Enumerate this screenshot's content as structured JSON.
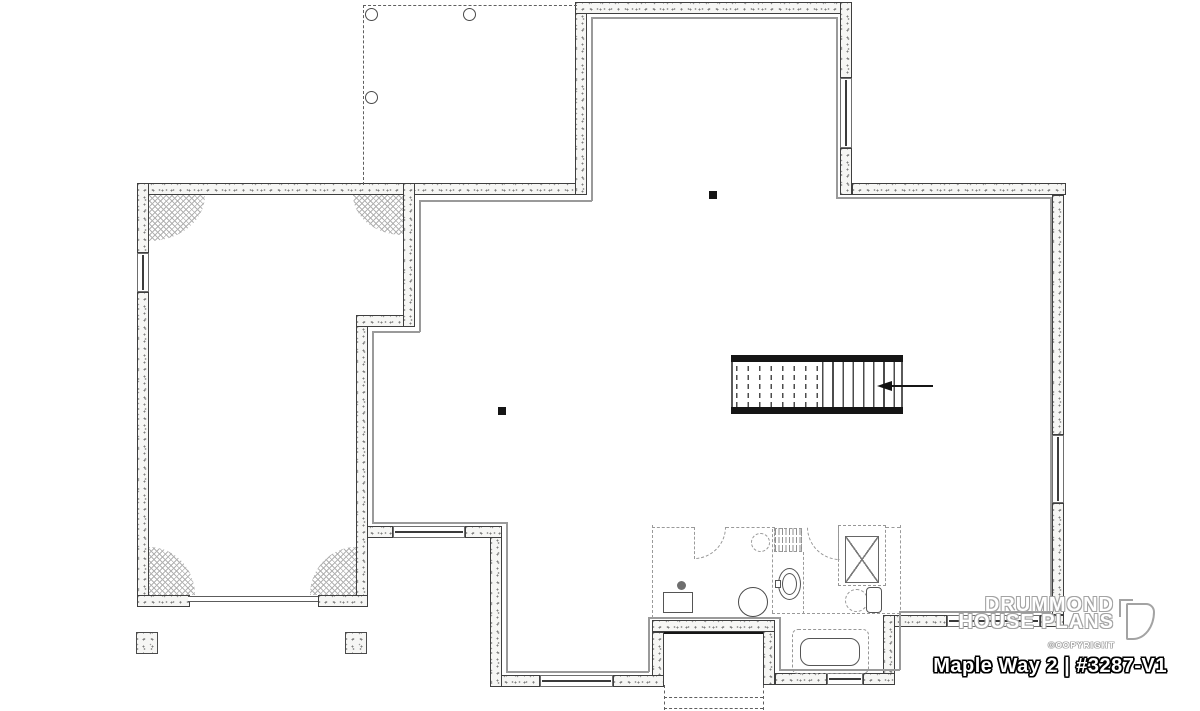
{
  "title_block": {
    "brand_line1": "DRUMMOND",
    "brand_line2": "HOUSE PLANS",
    "copyright": "©COPYRIGHT",
    "plan_title": "Maple Way 2 | #3287-V1"
  },
  "colors": {
    "wall_line": "#3f3f3f",
    "stipple": "#8a8a8a",
    "finish_line": "#9a9a9a",
    "dash_dark": "#5f5f5f",
    "dash_light": "#9a9a9a",
    "fixture_line": "#555555",
    "title_fill": "#ffffff",
    "title_outline": "#000000",
    "brand_outline": "#a3a3a3"
  },
  "plan": {
    "items": [
      {
        "t": "wall",
        "n": "garage-top-wall",
        "x": 137,
        "y": 183,
        "w": 440,
        "h": 12
      },
      {
        "t": "wall",
        "n": "projection-left-wall",
        "x": 575,
        "y": 2,
        "w": 12,
        "h": 193
      },
      {
        "t": "wall",
        "n": "projection-top-wall",
        "x": 575,
        "y": 2,
        "w": 277,
        "h": 12
      },
      {
        "t": "wall",
        "n": "projection-right-wall-upper",
        "x": 840,
        "y": 2,
        "w": 12,
        "h": 76
      },
      {
        "t": "wall",
        "n": "projection-right-wall-lower",
        "x": 840,
        "y": 148,
        "w": 12,
        "h": 47
      },
      {
        "t": "wall",
        "n": "top-right-wall",
        "x": 852,
        "y": 183,
        "w": 214,
        "h": 12
      },
      {
        "t": "wall",
        "n": "right-wall-upper",
        "x": 1052,
        "y": 195,
        "w": 12,
        "h": 240
      },
      {
        "t": "wall",
        "n": "right-wall-lower",
        "x": 1052,
        "y": 503,
        "w": 12,
        "h": 112
      },
      {
        "t": "wall",
        "n": "bottom-right-wall",
        "x": 883,
        "y": 615,
        "w": 64,
        "h": 12
      },
      {
        "t": "wall",
        "n": "bottom-right-corner-wall",
        "x": 1040,
        "y": 615,
        "w": 24,
        "h": 12
      },
      {
        "t": "wall",
        "n": "bath-step-wall",
        "x": 883,
        "y": 615,
        "w": 12,
        "h": 70
      },
      {
        "t": "wall",
        "n": "bath-bottom-wall-left",
        "x": 775,
        "y": 673,
        "w": 52,
        "h": 12
      },
      {
        "t": "wall",
        "n": "bath-bottom-wall-right",
        "x": 863,
        "y": 673,
        "w": 32,
        "h": 12
      },
      {
        "t": "wall",
        "n": "stairwell-right-wall",
        "x": 763,
        "y": 620,
        "w": 12,
        "h": 65
      },
      {
        "t": "wall",
        "n": "stairwell-top-wall",
        "x": 652,
        "y": 620,
        "w": 123,
        "h": 12
      },
      {
        "t": "wall",
        "n": "stairwell-left-wall",
        "x": 652,
        "y": 632,
        "w": 12,
        "h": 53
      },
      {
        "t": "wall",
        "n": "bottom-mid-wall-left",
        "x": 490,
        "y": 675,
        "w": 50,
        "h": 12
      },
      {
        "t": "wall",
        "n": "bottom-mid-wall-right",
        "x": 613,
        "y": 675,
        "w": 51,
        "h": 12
      },
      {
        "t": "wall",
        "n": "sw-vertical-wall",
        "x": 490,
        "y": 526,
        "w": 12,
        "h": 161
      },
      {
        "t": "wall",
        "n": "mid-bottom-wall-left",
        "x": 356,
        "y": 526,
        "w": 37,
        "h": 12
      },
      {
        "t": "wall",
        "n": "mid-bottom-wall-right",
        "x": 465,
        "y": 526,
        "w": 37,
        "h": 12
      },
      {
        "t": "wall",
        "n": "garage-basement-wall-lower",
        "x": 356,
        "y": 315,
        "w": 12,
        "h": 292
      },
      {
        "t": "wall",
        "n": "garage-step-wall",
        "x": 356,
        "y": 315,
        "w": 59,
        "h": 12
      },
      {
        "t": "wall",
        "n": "garage-basement-wall-upper",
        "x": 403,
        "y": 183,
        "w": 12,
        "h": 144
      },
      {
        "t": "wall",
        "n": "garage-left-wall-upper",
        "x": 137,
        "y": 183,
        "w": 12,
        "h": 70
      },
      {
        "t": "wall",
        "n": "garage-left-wall-lower",
        "x": 137,
        "y": 292,
        "w": 12,
        "h": 315
      },
      {
        "t": "wall",
        "n": "garage-front-wall-left",
        "x": 137,
        "y": 595,
        "w": 53,
        "h": 12
      },
      {
        "t": "wall",
        "n": "garage-front-wall-right",
        "x": 318,
        "y": 595,
        "w": 50,
        "h": 12
      },
      {
        "t": "win",
        "o": "v",
        "n": "window",
        "x": 840,
        "y": 78,
        "w": 12,
        "h": 70
      },
      {
        "t": "win",
        "o": "v",
        "n": "window",
        "x": 1052,
        "y": 435,
        "w": 12,
        "h": 68
      },
      {
        "t": "win",
        "o": "v",
        "n": "window",
        "x": 137,
        "y": 253,
        "w": 12,
        "h": 39
      },
      {
        "t": "win",
        "o": "h",
        "n": "window",
        "x": 393,
        "y": 526,
        "w": 72,
        "h": 12
      },
      {
        "t": "win",
        "o": "h",
        "n": "window",
        "x": 540,
        "y": 675,
        "w": 73,
        "h": 12
      },
      {
        "t": "win",
        "o": "h",
        "n": "window",
        "x": 827,
        "y": 673,
        "w": 36,
        "h": 12
      },
      {
        "t": "win",
        "o": "h",
        "n": "window",
        "x": 947,
        "y": 615,
        "w": 93,
        "h": 12
      },
      {
        "t": "door",
        "n": "garage-door",
        "x": 188,
        "y": 596,
        "w": 130,
        "h": 6
      },
      {
        "t": "fin",
        "n": "wall-finish-line",
        "x": 591,
        "y": 17,
        "w": 245,
        "h": 1.5
      },
      {
        "t": "fin",
        "n": "wall-finish-line",
        "x": 836,
        "y": 17,
        "w": 1.5,
        "h": 181
      },
      {
        "t": "fin",
        "n": "wall-finish-line",
        "x": 836,
        "y": 197,
        "w": 215,
        "h": 1.5
      },
      {
        "t": "fin",
        "n": "wall-finish-line",
        "x": 1050,
        "y": 197,
        "w": 1.5,
        "h": 415
      },
      {
        "t": "fin",
        "n": "wall-finish-line",
        "x": 899,
        "y": 611,
        "w": 152,
        "h": 1.5
      },
      {
        "t": "fin",
        "n": "wall-finish-line",
        "x": 899,
        "y": 611,
        "w": 1.5,
        "h": 59
      },
      {
        "t": "fin",
        "n": "wall-finish-line",
        "x": 779,
        "y": 669,
        "w": 121,
        "h": 1.5
      },
      {
        "t": "fin",
        "n": "wall-finish-line",
        "x": 779,
        "y": 617,
        "w": 1.5,
        "h": 53
      },
      {
        "t": "fin",
        "n": "wall-finish-line",
        "x": 648,
        "y": 617,
        "w": 132,
        "h": 1.5
      },
      {
        "t": "fin",
        "n": "wall-finish-line",
        "x": 648,
        "y": 617,
        "w": 1.5,
        "h": 55
      },
      {
        "t": "fin",
        "n": "wall-finish-line",
        "x": 506,
        "y": 671,
        "w": 143,
        "h": 1.5
      },
      {
        "t": "fin",
        "n": "wall-finish-line",
        "x": 506,
        "y": 522,
        "w": 1.5,
        "h": 150
      },
      {
        "t": "fin",
        "n": "wall-finish-line",
        "x": 372,
        "y": 522,
        "w": 135,
        "h": 1.5
      },
      {
        "t": "fin",
        "n": "wall-finish-line",
        "x": 372,
        "y": 331,
        "w": 1.5,
        "h": 192
      },
      {
        "t": "fin",
        "n": "wall-finish-line",
        "x": 372,
        "y": 331,
        "w": 48,
        "h": 1.5
      },
      {
        "t": "fin",
        "n": "wall-finish-line",
        "x": 419,
        "y": 200,
        "w": 1.5,
        "h": 132
      },
      {
        "t": "fin",
        "n": "wall-finish-line",
        "x": 419,
        "y": 200,
        "w": 173,
        "h": 1.5
      },
      {
        "t": "fin",
        "n": "wall-finish-line",
        "x": 591,
        "y": 17,
        "w": 1.5,
        "h": 184
      },
      {
        "t": "dh",
        "n": "porch-outline-dash",
        "x": 363,
        "y": 5,
        "w": 214,
        "h": 0
      },
      {
        "t": "dv",
        "n": "porch-outline-dash",
        "x": 363,
        "y": 5,
        "w": 0,
        "h": 180
      },
      {
        "t": "cir",
        "n": "porch-column",
        "x": 365,
        "y": 8,
        "w": 13,
        "h": 13
      },
      {
        "t": "cir",
        "n": "porch-column",
        "x": 463,
        "y": 8,
        "w": 13,
        "h": 13
      },
      {
        "t": "cir",
        "n": "porch-column",
        "x": 365,
        "y": 91,
        "w": 13,
        "h": 13
      },
      {
        "t": "footing",
        "n": "column-footing",
        "x": 136,
        "y": 632,
        "w": 22,
        "h": 22
      },
      {
        "t": "footing",
        "n": "column-footing",
        "x": 345,
        "y": 632,
        "w": 22,
        "h": 22
      },
      {
        "t": "hatch",
        "n": "corner-hatch",
        "x": 149,
        "y": 195,
        "w": 56,
        "h": 46,
        "r": "0 0 100% 0"
      },
      {
        "t": "hatch",
        "n": "corner-hatch",
        "x": 353,
        "y": 195,
        "w": 50,
        "h": 40,
        "r": "0 0 0 100%"
      },
      {
        "t": "hatch",
        "n": "corner-hatch",
        "x": 149,
        "y": 547,
        "w": 46,
        "h": 48,
        "r": "0 100% 0 0"
      },
      {
        "t": "hatch",
        "n": "corner-hatch",
        "x": 310,
        "y": 547,
        "w": 46,
        "h": 48,
        "r": "100% 0 0 0"
      },
      {
        "t": "bar",
        "n": "walkout-threshold",
        "x": 664,
        "y": 632,
        "w": 99,
        "h": 2
      },
      {
        "t": "dv",
        "n": "exterior-stair-dash",
        "x": 664,
        "y": 685,
        "w": 0,
        "h": 25
      },
      {
        "t": "dv",
        "n": "exterior-stair-dash",
        "x": 763,
        "y": 685,
        "w": 0,
        "h": 25
      },
      {
        "t": "dh",
        "n": "exterior-stair-dash",
        "x": 664,
        "y": 697,
        "w": 99,
        "h": 0
      },
      {
        "t": "dh",
        "n": "exterior-stair-dash",
        "x": 664,
        "y": 708,
        "w": 99,
        "h": 0
      },
      {
        "t": "bar",
        "n": "stair-stringer-top",
        "x": 731,
        "y": 355,
        "w": 172,
        "h": 7
      },
      {
        "t": "bar",
        "n": "stair-stringer-bottom",
        "x": 731,
        "y": 407,
        "w": 172,
        "h": 7
      },
      {
        "t": "treadsd",
        "n": "stair-treads-hidden",
        "x": 736,
        "y": 362,
        "w": 86,
        "h": 45
      },
      {
        "t": "treadss",
        "n": "stair-treads",
        "x": 822,
        "y": 362,
        "w": 80,
        "h": 45
      },
      {
        "t": "vthin",
        "n": "stair-edge",
        "x": 731,
        "y": 362,
        "w": 1.5,
        "h": 45
      },
      {
        "t": "vthin",
        "n": "stair-edge",
        "x": 901,
        "y": 362,
        "w": 1.5,
        "h": 45
      },
      {
        "t": "bar",
        "n": "stair-direction-line",
        "x": 881,
        "y": 385,
        "w": 52,
        "h": 1.8
      },
      {
        "t": "tri",
        "n": "stair-direction-arrow",
        "x": 877,
        "y": 381,
        "w": 0,
        "h": 0
      },
      {
        "t": "bar",
        "n": "structural-post",
        "x": 709,
        "y": 191,
        "w": 8,
        "h": 8
      },
      {
        "t": "bar",
        "n": "structural-post",
        "x": 498,
        "y": 407,
        "w": 8,
        "h": 8
      },
      {
        "t": "dvg",
        "n": "bath-partition-dash",
        "x": 652,
        "y": 525,
        "w": 0,
        "h": 93
      },
      {
        "t": "dhg",
        "n": "bath-partition-dash",
        "x": 652,
        "y": 527,
        "w": 42,
        "h": 0
      },
      {
        "t": "dhg",
        "n": "bath-partition-dash",
        "x": 726,
        "y": 527,
        "w": 49,
        "h": 0
      },
      {
        "t": "dvg",
        "n": "bath-partition-dash",
        "x": 772,
        "y": 529,
        "w": 0,
        "h": 84
      },
      {
        "t": "dvg",
        "n": "bath-partition-dash",
        "x": 803,
        "y": 552,
        "w": 0,
        "h": 62
      },
      {
        "t": "dhg",
        "n": "bath-partition-dash",
        "x": 772,
        "y": 613,
        "w": 128,
        "h": 0
      },
      {
        "t": "dvg",
        "n": "bath-partition-dash",
        "x": 900,
        "y": 525,
        "w": 0,
        "h": 90
      },
      {
        "t": "dhg",
        "n": "bath-partition-dash",
        "x": 886,
        "y": 527,
        "w": 14,
        "h": 0
      },
      {
        "t": "dvg",
        "n": "door-leaf-dash",
        "x": 694,
        "y": 527,
        "w": 0,
        "h": 32
      },
      {
        "t": "dvg",
        "n": "door-leaf-dash",
        "x": 838,
        "y": 527,
        "w": 0,
        "h": 33
      },
      {
        "t": "arc",
        "pos": "tl",
        "n": "door-swing-arc",
        "x": 694,
        "y": 527,
        "w": 32,
        "h": 32
      },
      {
        "t": "arc",
        "pos": "tr",
        "n": "door-swing-arc",
        "x": 807,
        "y": 527,
        "w": 33,
        "h": 33
      },
      {
        "t": "rrect",
        "n": "laundry-tub",
        "x": 663,
        "y": 592,
        "w": 30,
        "h": 21
      },
      {
        "t": "dot",
        "n": "floor-drain",
        "x": 677,
        "y": 581,
        "w": 9,
        "h": 9
      },
      {
        "t": "cir",
        "n": "water-heater",
        "x": 738,
        "y": 587,
        "w": 30,
        "h": 30
      },
      {
        "t": "cird",
        "n": "future-fixture",
        "x": 751,
        "y": 533,
        "w": 19,
        "h": 19
      },
      {
        "t": "el",
        "n": "pedestal-sink",
        "x": 778,
        "y": 568,
        "w": 23,
        "h": 32
      },
      {
        "t": "el",
        "n": "sink-basin",
        "x": 782,
        "y": 573,
        "w": 15,
        "h": 22
      },
      {
        "t": "rrect",
        "n": "sink-faucet",
        "x": 775,
        "y": 580,
        "w": 6,
        "h": 8
      },
      {
        "t": "cird",
        "n": "toilet-bowl",
        "x": 845,
        "y": 589,
        "w": 23,
        "h": 23
      },
      {
        "t": "rrect",
        "n": "toilet-tank",
        "x": 866,
        "y": 587,
        "w": 16,
        "h": 26,
        "r": "4px"
      },
      {
        "t": "rrectd",
        "n": "shower-enclosure",
        "x": 838,
        "y": 525,
        "w": 48,
        "h": 61
      },
      {
        "t": "xbox",
        "n": "shower-base",
        "x": 845,
        "y": 536,
        "w": 34,
        "h": 47
      },
      {
        "t": "rrectd",
        "n": "bathtub-enclosure",
        "x": 792,
        "y": 629,
        "w": 77,
        "h": 45,
        "r": "6px"
      },
      {
        "t": "rrect",
        "n": "bathtub",
        "x": 800,
        "y": 638,
        "w": 60,
        "h": 28,
        "r": "10px"
      },
      {
        "t": "shelf",
        "n": "linen-shelves",
        "x": 774,
        "y": 528,
        "w": 28,
        "h": 24
      }
    ]
  }
}
